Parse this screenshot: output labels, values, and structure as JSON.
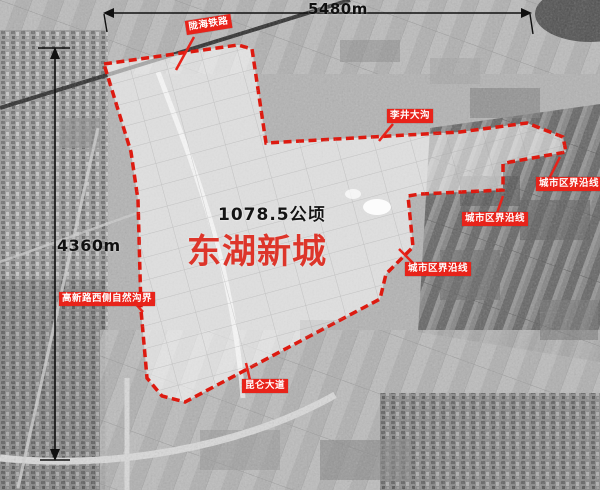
{
  "map": {
    "title": "东湖新城",
    "area": "1078.5公顷",
    "width_dim": "5480m",
    "height_dim": "4360m",
    "labels": {
      "railway": "陇海铁路",
      "ditch": "李井大沟",
      "city_boundary_a": "城市区界沿线",
      "city_boundary_b": "城市区界沿线",
      "city_boundary_c": "城市区界沿线",
      "natural_ditch_boundary": "高新路西侧自然沟界",
      "avenue": "昆仑大道"
    },
    "colors": {
      "boundary_red": "#dd1a10",
      "tag_background": "#e8231a",
      "tag_text": "#ffffff",
      "title_red": "#dd352a",
      "dimension_black": "#101010"
    }
  }
}
